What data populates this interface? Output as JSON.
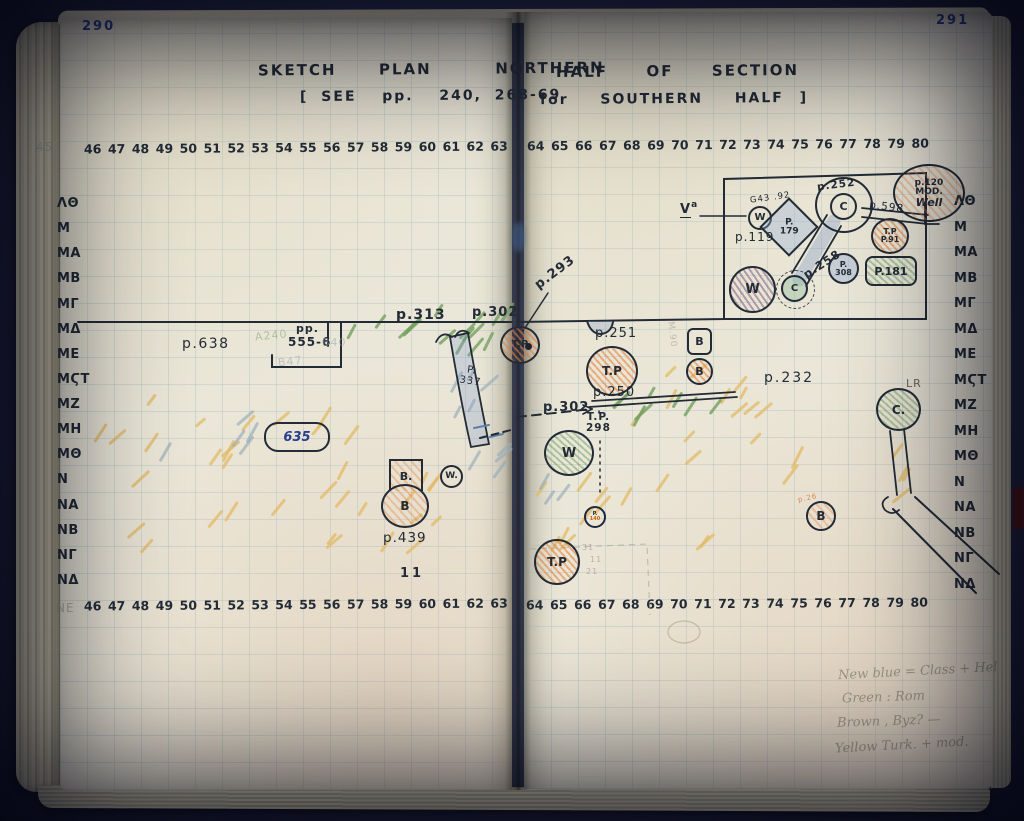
{
  "book": {
    "page_left_number": "290",
    "page_right_number": "291"
  },
  "title": {
    "line1_left": "SKETCH  PLAN   NORTHERN",
    "line1_right": "HALF  OF  SECTION",
    "line2_left": "[ SEE  pp.  240, 268-69",
    "line2_right": "for  SOUTHERN  HALF ]"
  },
  "grid": {
    "top_left_numbers": [
      "46",
      "47",
      "48",
      "49",
      "50",
      "51",
      "52",
      "53",
      "54",
      "55",
      "56",
      "57",
      "58",
      "59",
      "60",
      "61",
      "62",
      "63"
    ],
    "top_right_numbers": [
      "64",
      "65",
      "66",
      "67",
      "68",
      "69",
      "70",
      "71",
      "72",
      "73",
      "74",
      "75",
      "76",
      "77",
      "78",
      "79",
      "80"
    ],
    "bottom_left_numbers": [
      "46",
      "47",
      "48",
      "49",
      "50",
      "51",
      "52",
      "53",
      "54",
      "55",
      "56",
      "57",
      "58",
      "59",
      "60",
      "61",
      "62",
      "63"
    ],
    "bottom_right_numbers": [
      "64",
      "65",
      "66",
      "67",
      "68",
      "69",
      "70",
      "71",
      "72",
      "73",
      "74",
      "75",
      "76",
      "77",
      "78",
      "79",
      "80"
    ],
    "left_row_labels": [
      "ΛΘ",
      "Μ",
      "ΜΑ",
      "ΜΒ",
      "ΜΓ",
      "ΜΔ",
      "ΜΕ",
      "ΜϚΤ",
      "ΜΖ",
      "ΜΗ",
      "ΜΘ",
      "Ν",
      "ΝΑ",
      "ΝΒ",
      "ΝΓ",
      "ΝΔ"
    ],
    "right_row_labels": [
      "ΛΘ",
      "Μ",
      "ΜΑ",
      "ΜΒ",
      "ΜΓ",
      "ΜΔ",
      "ΜΕ",
      "ΜϚΤ",
      "ΜΖ",
      "ΜΗ",
      "ΜΘ",
      "Ν",
      "ΝΑ",
      "ΝΒ",
      "ΝΓ",
      "ΝΔ"
    ],
    "faint_column_number": "45",
    "faint_row_label": "ΝΕ"
  },
  "plan": {
    "p638": "p.638",
    "pp555_a": "pp.",
    "pp555_b": "555-6",
    "a240": "A240",
    "b40": "B40",
    "b47": "B47",
    "p313": "p.313",
    "p302_top": "p.302",
    "p293": "p.293",
    "p337_a": "P.",
    "p337_b": "337",
    "tp_gutter": "T.P",
    "blob635": "635",
    "flask_top": "B.",
    "flask_bottom": "B",
    "w_small": "W.",
    "p439": "p.439",
    "ticks": "11",
    "va_letter": "V",
    "va_sup": "a",
    "w_in_rect": "W",
    "g43": "G43 .92",
    "p119": "p.119",
    "diamond_a": "P.",
    "diamond_b": "179",
    "p252": "p.252",
    "c_inner": "C",
    "p258": "p.258",
    "p308_a": "P.",
    "p308_b": "308",
    "tp91_a": "T.P",
    "tp91_b": "P.91",
    "p181": "P.181",
    "w_big": "W",
    "c_small": "C",
    "p598": "p.598",
    "well_a": "p.120",
    "well_b": "MOD.",
    "well_c": "Well",
    "p251": "p.251",
    "b_square": "B",
    "b_circle": "B",
    "tp_mid": "T.P",
    "p250": "p.250",
    "p302_mid": "p.302",
    "tp298_a": "T.P.",
    "tp298_b": "298",
    "w_green": "W",
    "p232": "p.232",
    "lr": "LR",
    "c_lr": "C.",
    "p140_a": "P.",
    "p140_b": "140",
    "b_right": "B",
    "b_right_faint": "p.26",
    "tp_bottom": "T.P",
    "m90": "M.90",
    "pencil_mark_1": "31",
    "pencil_mark_2": "11",
    "pencil_mark_3": "21"
  },
  "note": {
    "line1": "New blue = Class + Hel",
    "line2": "Green : Rom",
    "line3": "Brown , Byz? —",
    "line4": "Yellow Turk. + mod."
  },
  "colors": {
    "ink": "#222b36",
    "blue_ink": "#2b3d8c",
    "orange": "#e07b3a",
    "green": "#6f9c63",
    "yellow": "#e4bd6a",
    "blue_wash": "#7d9cc4",
    "purple": "#8c6f8f",
    "pencil": "#8f8a7c",
    "page": "#ebe7d8",
    "cover": "#2e3354"
  }
}
